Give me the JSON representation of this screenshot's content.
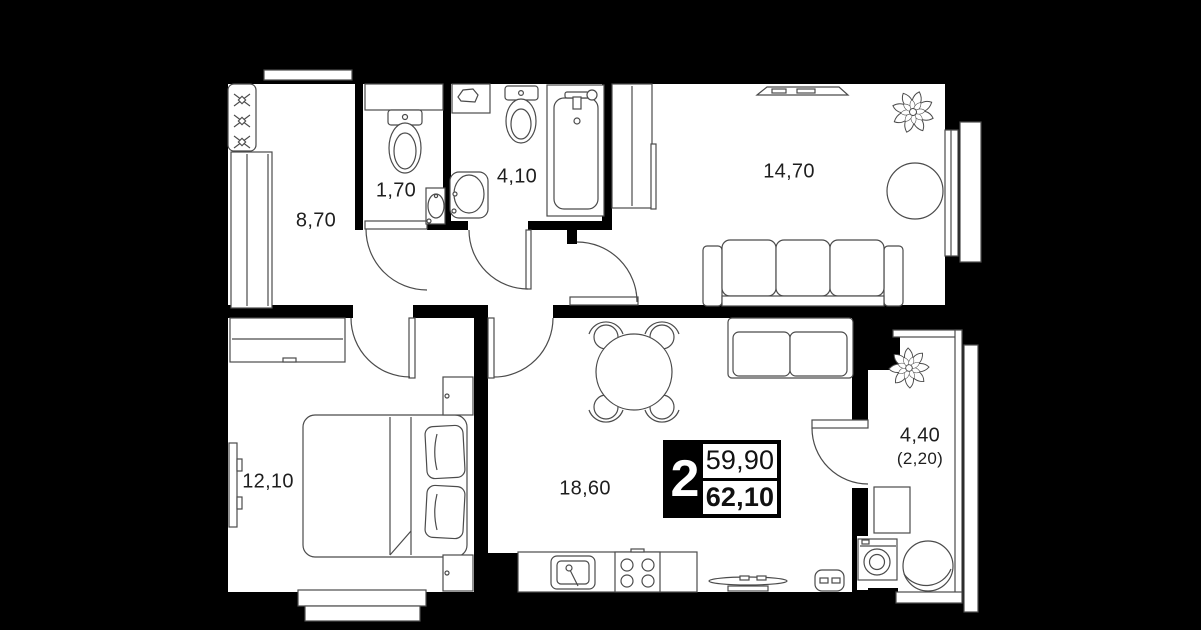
{
  "plan": {
    "type": "apartment-floor-plan",
    "badge": {
      "rooms_count": "2",
      "area_living": "59,90",
      "area_total": "62,10"
    },
    "rooms": [
      {
        "id": "hallway",
        "area": "8,70"
      },
      {
        "id": "wc",
        "area": "1,70"
      },
      {
        "id": "bathroom",
        "area": "4,10"
      },
      {
        "id": "living-room",
        "area": "14,70"
      },
      {
        "id": "bedroom",
        "area": "12,10"
      },
      {
        "id": "kitchen-living-room",
        "area": "18,60"
      },
      {
        "id": "balcony",
        "area": "4,40",
        "area_reduced": "(2,20)"
      }
    ],
    "furniture_icons": [
      "coat-hooks-icon",
      "wardrobe-icon",
      "toilet-icon",
      "sink-icon",
      "bathtub-icon",
      "laundry-shelf-icon",
      "tv-console-icon",
      "plant-icon",
      "round-chair-icon",
      "sofa-icon",
      "desk-icon",
      "bed-icon",
      "tv-icon",
      "nightstand-icon",
      "dining-table-icon",
      "chair-icon",
      "kitchen-sink-icon",
      "stove-icon",
      "washing-machine-icon",
      "balcony-table-icon",
      "window",
      "door-arc"
    ],
    "colors": {
      "background": "#000000",
      "walls": "#000000",
      "floor": "#ffffff",
      "furniture_line": "#4b4b4b",
      "text": "#1e1e1e",
      "badge_bg": "#ffffff",
      "badge_accent": "#000000"
    }
  }
}
